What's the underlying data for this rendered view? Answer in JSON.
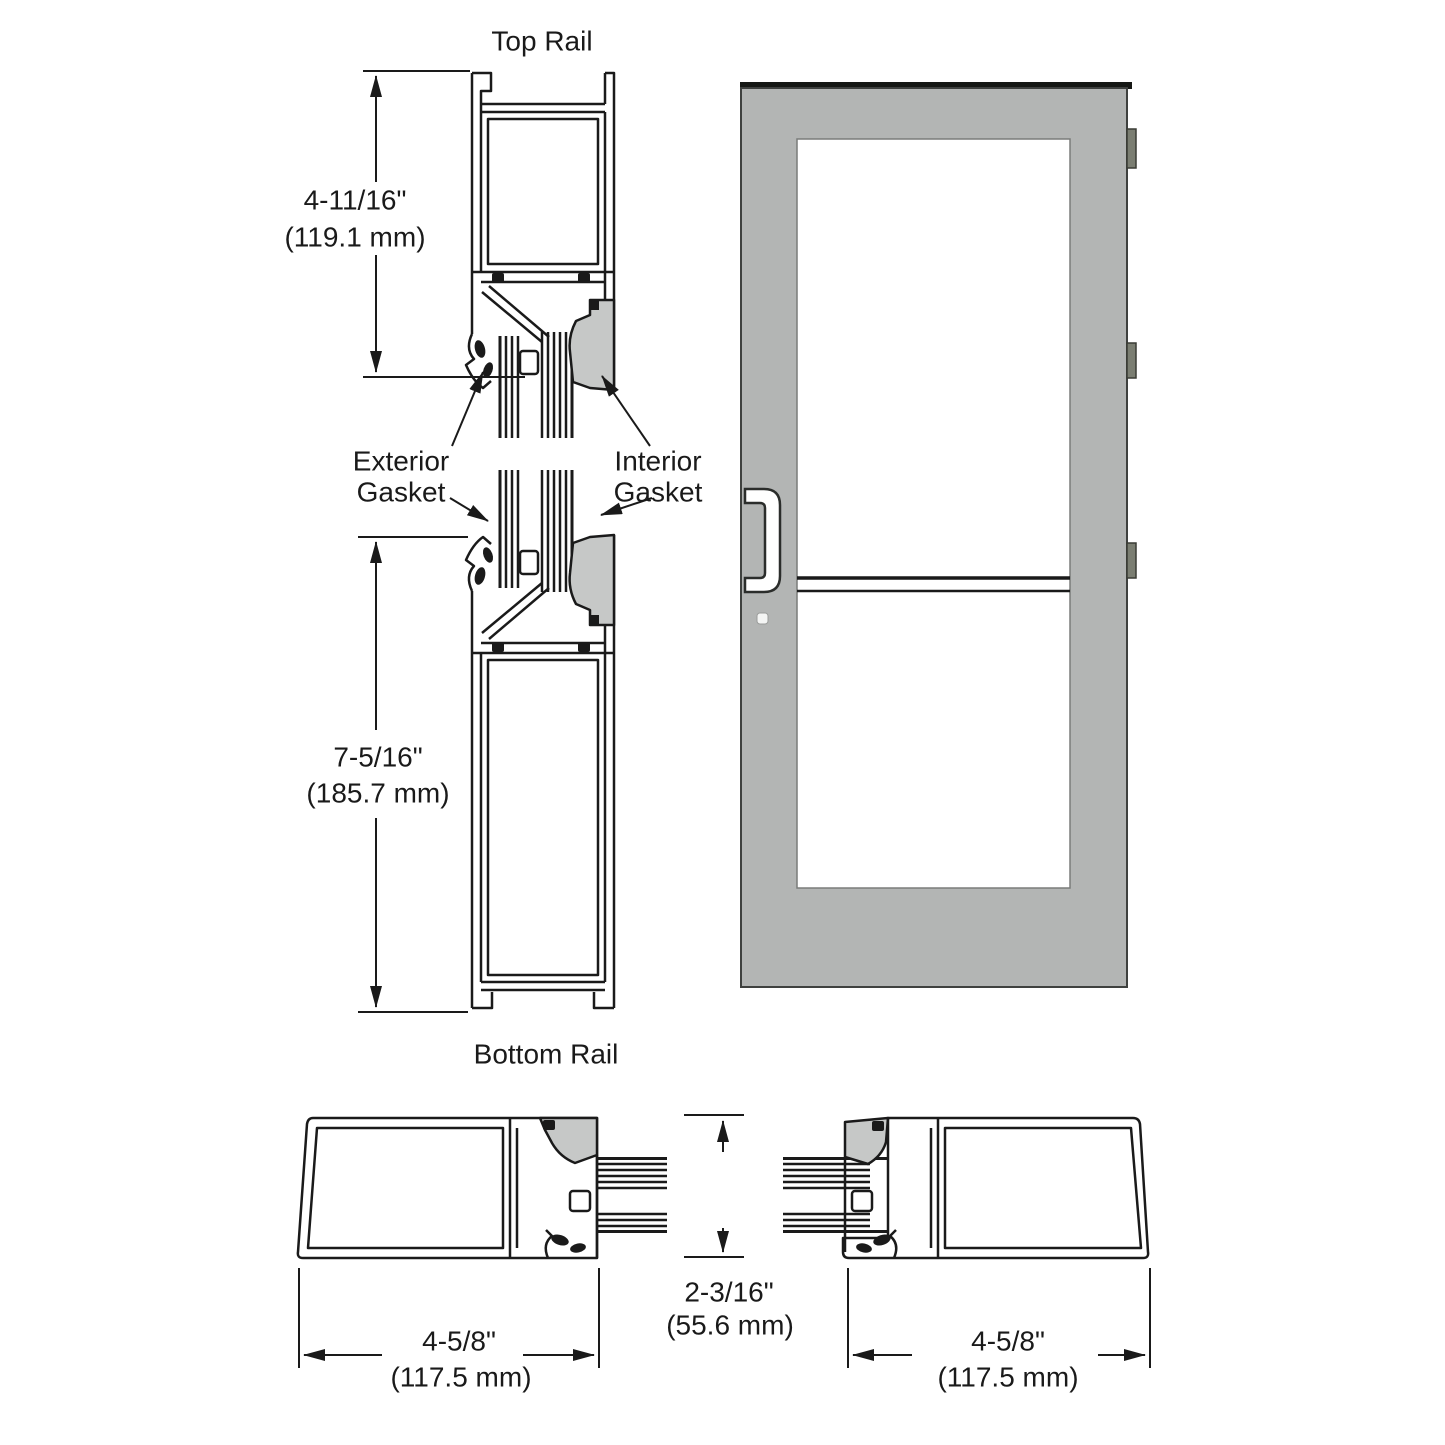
{
  "diagram_title": "Storefront door rail and stile cross-sections",
  "labels": {
    "top_rail": "Top Rail",
    "bottom_rail": "Bottom Rail",
    "exterior_gasket_line1": "Exterior",
    "exterior_gasket_line2": "Gasket",
    "interior_gasket_line1": "Interior",
    "interior_gasket_line2": "Gasket"
  },
  "dimensions": {
    "top_rail": {
      "imperial": "4-11/16\"",
      "metric": "(119.1 mm)"
    },
    "bottom_rail": {
      "imperial": "7-5/16\"",
      "metric": "(185.7 mm)"
    },
    "lock_stile": {
      "imperial": "4-5/8\"",
      "metric": "(117.5 mm)"
    },
    "hinge_stile": {
      "imperial": "4-5/8\"",
      "metric": "(117.5 mm)"
    },
    "glazing_depth": {
      "imperial": "2-3/16\"",
      "metric": "(55.6 mm)"
    }
  },
  "colors": {
    "door_gray": "#b3b5b4",
    "glazing_bead_gray": "#c6c8c7",
    "hinge_gray": "#7b7e72",
    "line_black": "#1a1a1a",
    "background": "#ffffff"
  }
}
